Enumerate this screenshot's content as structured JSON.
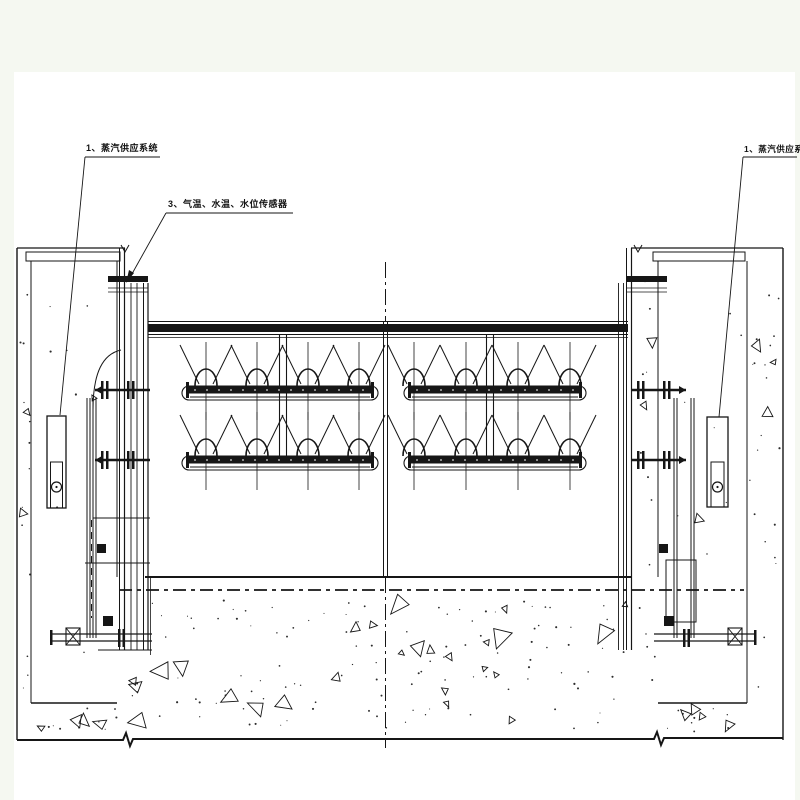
{
  "canvas": {
    "background": "#f5f8f1",
    "sheet": "#ffffff",
    "ink": "#161616"
  },
  "annotations": {
    "left_system": "1、蒸汽供应系统",
    "sensors": "3、气温、水温、水位传感器",
    "right_system": "1、蒸汽供应系统"
  }
}
